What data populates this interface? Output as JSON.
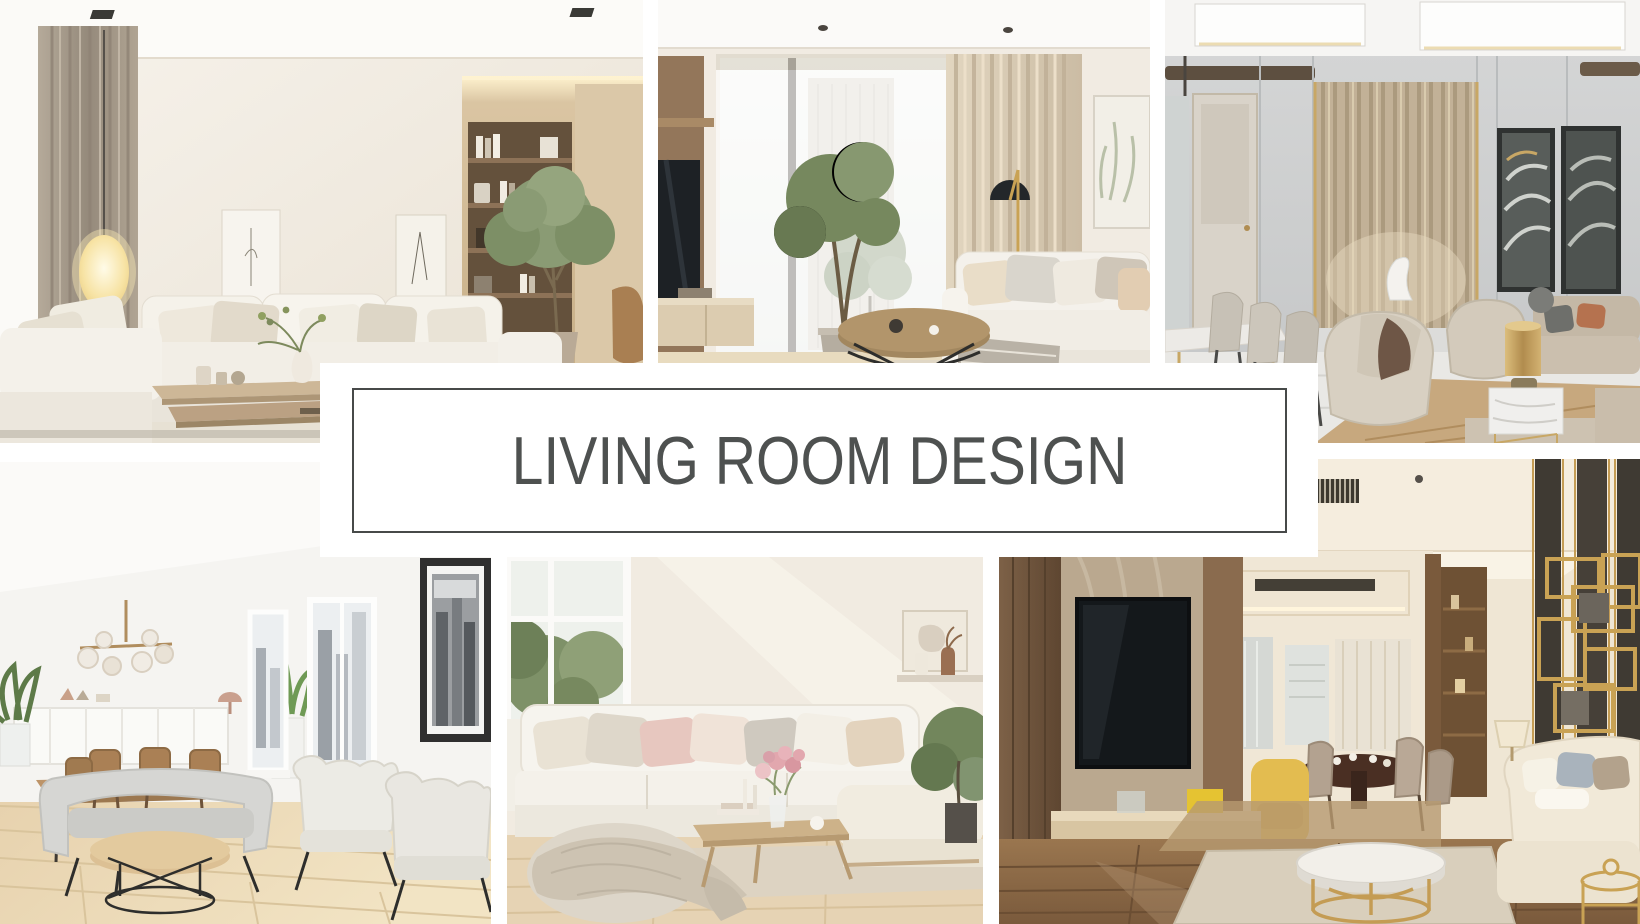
{
  "canvas": {
    "width": 1640,
    "height": 924,
    "background_color": "#ffffff"
  },
  "banner": {
    "title": "LIVING ROOM DESIGN",
    "text_color": "#4e5150",
    "border_color": "#474a49",
    "background_color": "#ffffff"
  },
  "collage": {
    "photos": [
      {
        "id": "top-left",
        "scene": "beige-sectional-sofa-lounge",
        "palette": [
          "#f2ede4",
          "#c6b191",
          "#64513c",
          "#8a9b74"
        ]
      },
      {
        "id": "top-middle",
        "scene": "tall-window-tv-lounge",
        "palette": [
          "#f1ebe2",
          "#d9ccb6",
          "#93765a",
          "#76885e"
        ]
      },
      {
        "id": "top-right",
        "scene": "gray-gold-lounge-with-dining",
        "palette": [
          "#ced0d1",
          "#c2b197",
          "#c4a05f",
          "#c3b7a5"
        ]
      },
      {
        "id": "bottom-left",
        "scene": "white-dining-and-armchair-room",
        "palette": [
          "#f5f4f1",
          "#ead8b8",
          "#d5d5d2",
          "#bd9468"
        ]
      },
      {
        "id": "bottom-middle",
        "scene": "cozy-white-sectional-with-flowers",
        "palette": [
          "#f1ebe1",
          "#f6f3ed",
          "#e6c6be",
          "#e6d3b4"
        ]
      },
      {
        "id": "bottom-right",
        "scene": "warm-modern-lounge-gold-accents",
        "palette": [
          "#8f6c4b",
          "#efe6d4",
          "#c49c54",
          "#e2bd45"
        ]
      }
    ]
  }
}
